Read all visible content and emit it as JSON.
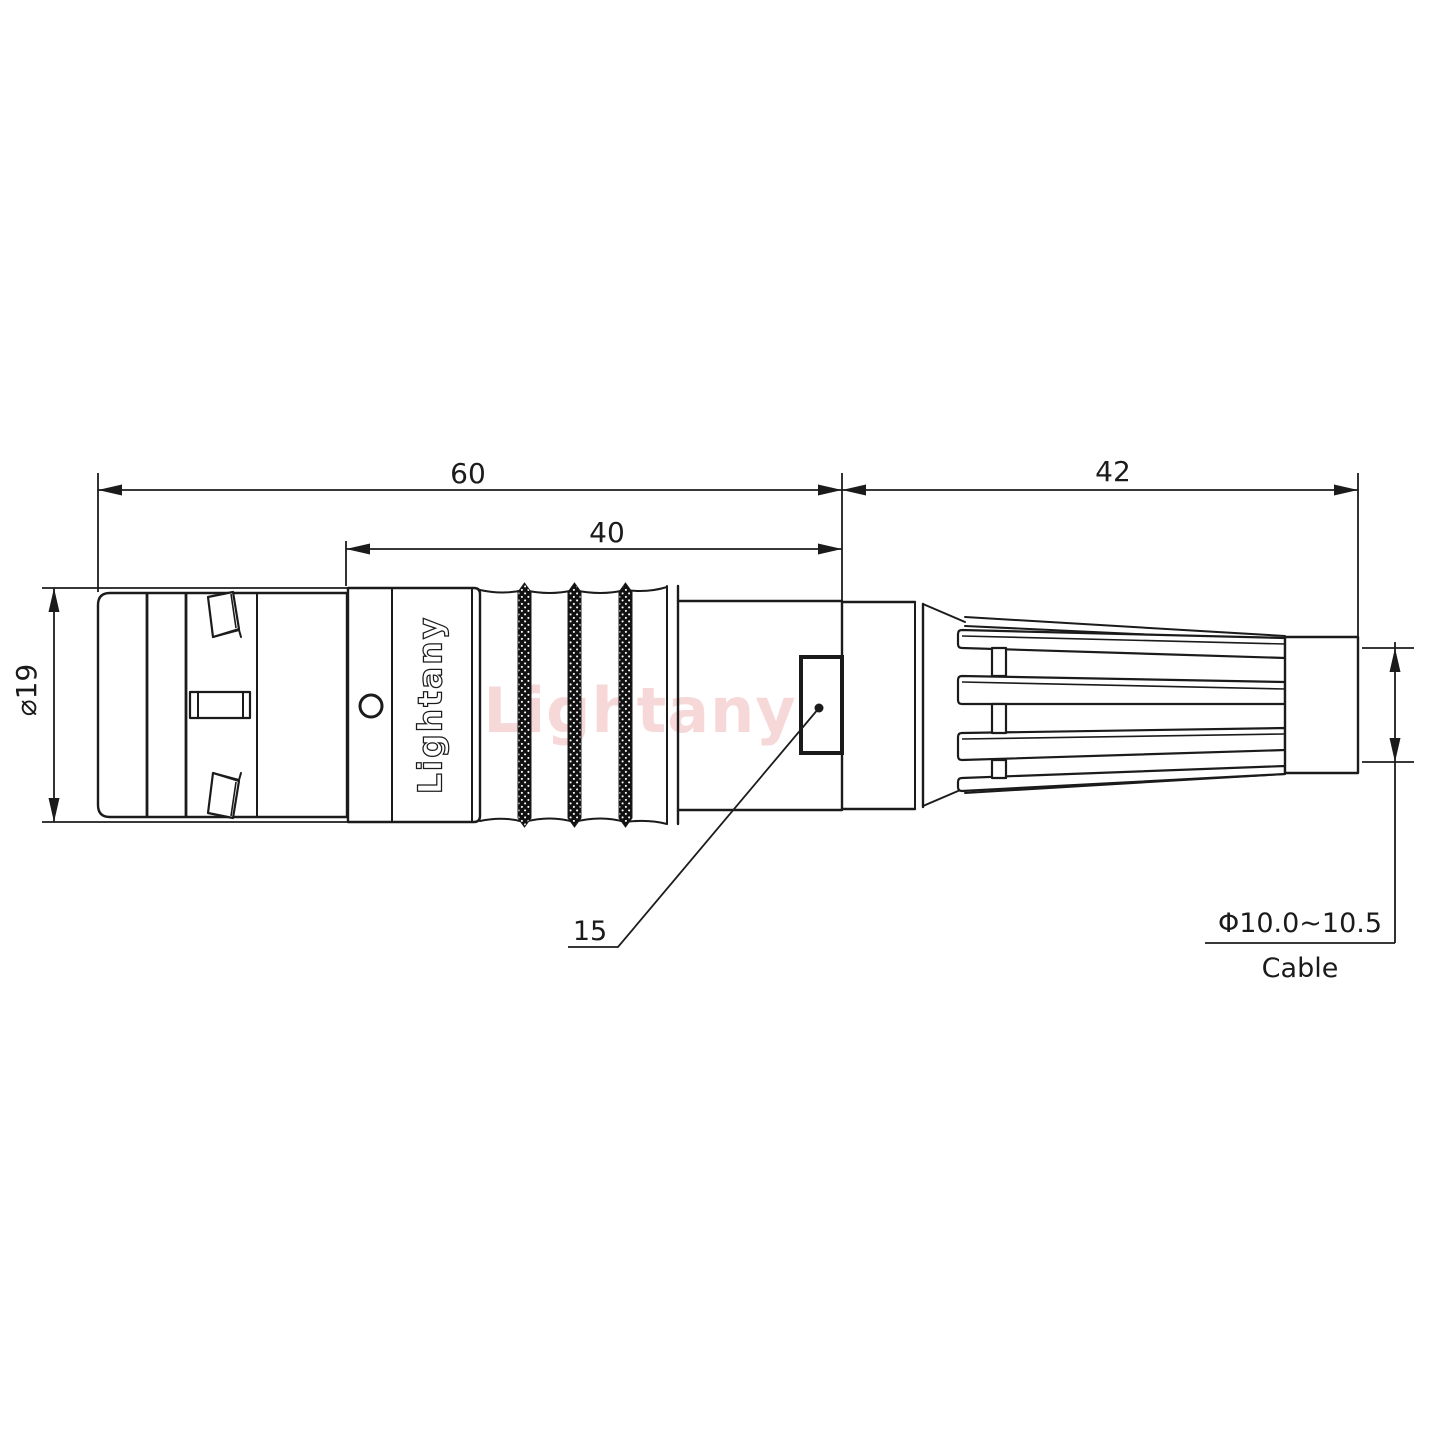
{
  "drawing": {
    "dimensions": {
      "overall_length": "60",
      "body_length": "40",
      "boot_length": "42",
      "shell_diameter": "⌀19",
      "leader_ref": "15",
      "cable_range": "Φ10.0~10.5",
      "cable_label": "Cable"
    },
    "branding": {
      "engraving": "Lightany",
      "watermark": "Lightany"
    },
    "colors": {
      "line": "#1b1b1b",
      "background": "#ffffff",
      "watermark_pink": "#eeb2b2"
    }
  }
}
